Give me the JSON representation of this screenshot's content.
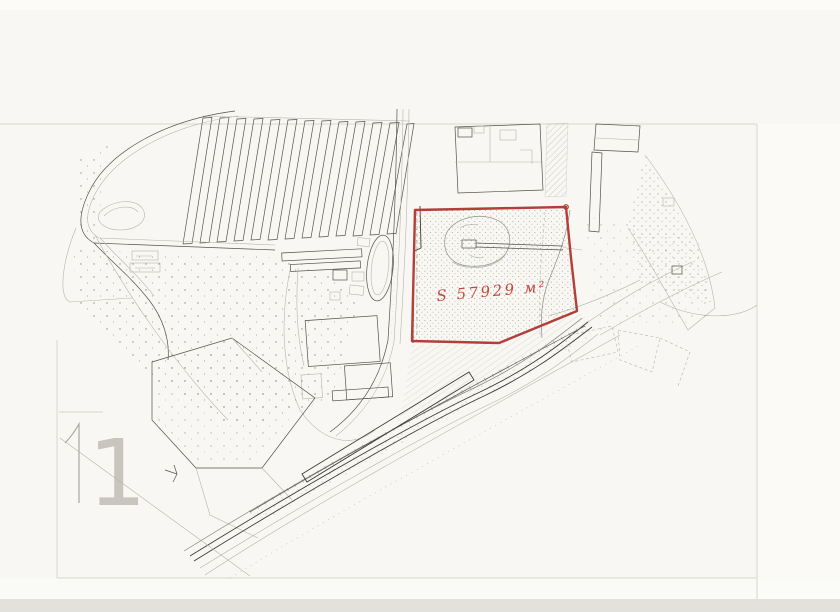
{
  "document": {
    "sheet_number": "1",
    "area_label": "S 57929 м²"
  },
  "colors": {
    "paper": "#f8f7f3",
    "paper_bright": "#fcfbf8",
    "scan_edge": "#e2e1db",
    "ink": "#55534a",
    "ink_dark": "#3e3c35",
    "ink_faint": "#b7b5ab",
    "crease": "#d9d7cf",
    "pencil_green": "#98a18f",
    "hatch_green": "#a3b0a0",
    "parcel_red": "#b23f38",
    "label_red": "#c4473e"
  }
}
